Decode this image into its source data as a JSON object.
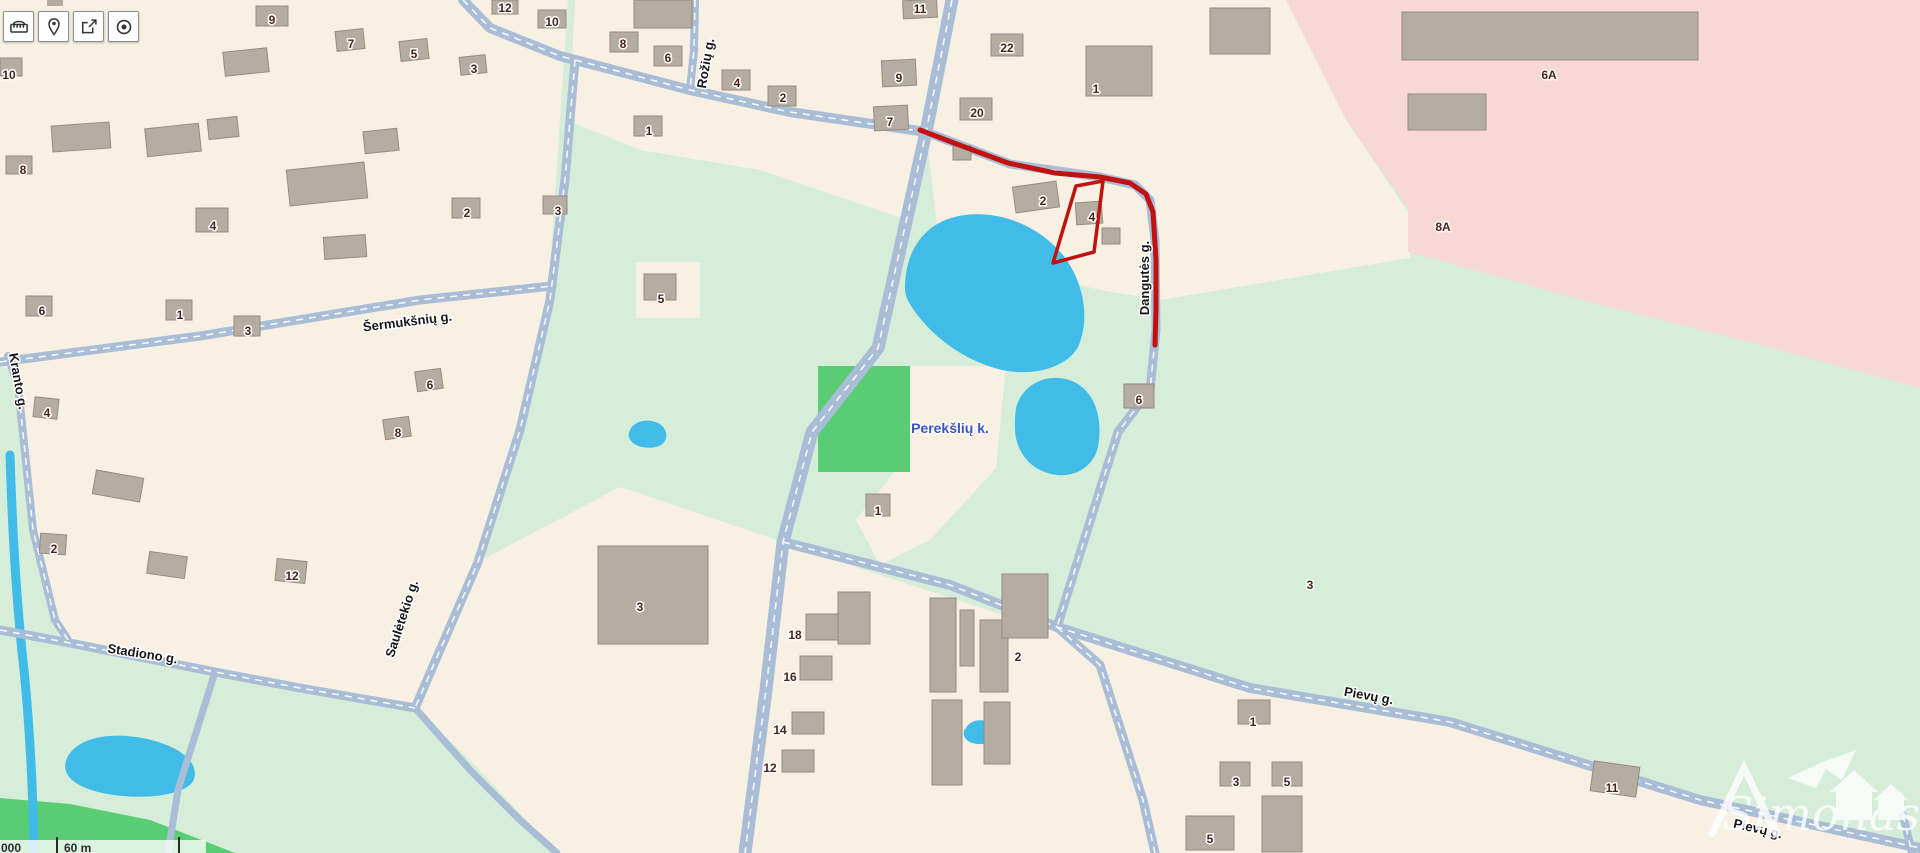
{
  "title": "Map viewer — Perekšlių k.",
  "toolbar": {
    "buttons": [
      {
        "name": "measure",
        "icon": "ruler-icon"
      },
      {
        "name": "location-pin",
        "icon": "pin-icon"
      },
      {
        "name": "share",
        "icon": "share-icon"
      },
      {
        "name": "locate",
        "icon": "target-icon"
      }
    ]
  },
  "scalebar": {
    "left_text": "000",
    "label": "60 m"
  },
  "watermark": {
    "text": "Simonas"
  },
  "map": {
    "colors": {
      "base": "#d6edd9",
      "cream": "#f8f0e2",
      "pink": "#f8d8d4",
      "green": "#58cd74",
      "water": "#41bce8",
      "road": "#a9bdd6",
      "building": "#b5ada1",
      "building_edge": "#948c7f",
      "red": "#c11212",
      "number_text": "#4a241c",
      "street_text": "#161616",
      "place_text": "#3a53c4"
    },
    "areas": [
      {
        "name": "left-residential-block",
        "color": "cream",
        "pts": "0,0 568,0 560,120 548,300 520,430 478,562 415,708 215,672 70,643 0,628"
      },
      {
        "name": "top-middle-block",
        "color": "cream",
        "pts": "575,0 952,0 926,132 908,220 760,170 640,150 566,120 572,60"
      },
      {
        "name": "kranto-wedge-meadow",
        "color": "base",
        "pts": "0,366 12,370 26,460 40,560 62,628 72,646 0,636"
      },
      {
        "name": "patch-house5",
        "color": "cream",
        "pts": "636,262 700,262 700,318 636,318"
      },
      {
        "name": "northeast-block",
        "color": "cream",
        "pts": "926,0 1286,0 1346,120 1410,215 1410,258 1160,300 1100,290 1040,275 980,280 940,250 926,132"
      },
      {
        "name": "industrial-pink-zone",
        "color": "pink",
        "pts": "1286,0 1920,0 1920,388 1760,345 1600,305 1408,252 1408,208 1346,120"
      },
      {
        "name": "perekslu-farm-column",
        "color": "cream",
        "pts": "908,366 1006,366 996,468 930,540 880,565 856,520 896,470 905,420"
      },
      {
        "name": "playground-green",
        "color": "green",
        "pts": "818,366 910,366 910,472 818,472"
      },
      {
        "name": "southwest-center-block",
        "color": "cream",
        "pts": "478,562 620,487 783,542 766,690 748,853 557,853 470,760 415,708"
      },
      {
        "name": "industrial-south-block",
        "color": "cream",
        "pts": "788,545 1055,632 1100,668 1143,800 1153,853 750,853 770,690"
      },
      {
        "name": "southeast-block",
        "color": "cream",
        "pts": "1055,632 1250,690 1450,724 1700,802 1920,850 1920,853 1155,853 1143,800 1100,668"
      },
      {
        "name": "corner-green-strip",
        "color": "green",
        "pts": "0,798 70,804 150,820 235,853 0,853"
      }
    ],
    "lakes": [
      {
        "name": "big-pond",
        "d": "M905,288C905,250 925,220 965,215C1008,210 1048,232 1068,262C1084,287 1090,320 1078,347C1065,370 1028,377 998,369C962,359 936,338 919,317C908,303 905,296 905,288Z"
      },
      {
        "name": "small-pond-east",
        "d": "M1019,400C1029,379 1056,372 1076,383C1096,394 1103,420 1098,447C1093,468 1073,479 1051,474C1029,469 1015,450 1015,428C1015,416 1015,407 1019,400Z"
      },
      {
        "name": "tiny-pond-center",
        "d": "M630,430C634,421 648,418 658,423C668,428 669,440 661,445C652,450 637,448 631,441C628,437 628,434 630,430Z"
      },
      {
        "name": "southwest-pond",
        "d": "M67,758C77,737 112,731 147,739C182,747 199,763 194,779C189,794 150,800 114,795C84,791 58,779 67,758Z"
      },
      {
        "name": "tiny-pond-south",
        "d": "M966,728C970,720 982,718 989,723C996,728 996,738 989,742C981,746 969,744 965,738C963,734 963,731 966,728Z"
      }
    ],
    "stream": {
      "name": "west-stream",
      "d": "M10,455C12,520 16,600 24,670C30,730 33,790 34,853",
      "w": 9
    },
    "roads": [
      {
        "name": "main-road-north-south",
        "w": 13,
        "pts": [
          [
            952,
            0
          ],
          [
            926,
            132
          ],
          [
            878,
            348
          ],
          [
            812,
            432
          ],
          [
            783,
            542
          ],
          [
            766,
            690
          ],
          [
            745,
            853
          ]
        ]
      },
      {
        "name": "upper-east-west-road",
        "w": 10,
        "pts": [
          [
            463,
            0
          ],
          [
            490,
            28
          ],
          [
            560,
            56
          ],
          [
            690,
            90
          ],
          [
            790,
            112
          ],
          [
            926,
            132
          ]
        ]
      },
      {
        "name": "dangutes-road",
        "w": 9,
        "pts": [
          [
            926,
            132
          ],
          [
            1010,
            164
          ],
          [
            1100,
            177
          ],
          [
            1135,
            185
          ],
          [
            1150,
            200
          ],
          [
            1155,
            240
          ],
          [
            1156,
            330
          ],
          [
            1150,
            390
          ],
          [
            1118,
            432
          ],
          [
            1057,
            627
          ]
        ]
      },
      {
        "name": "sauletekio-road",
        "w": 9,
        "pts": [
          [
            575,
            60
          ],
          [
            565,
            180
          ],
          [
            550,
            300
          ],
          [
            520,
            430
          ],
          [
            478,
            562
          ],
          [
            415,
            708
          ]
        ]
      },
      {
        "name": "sermuksnu-road",
        "w": 9,
        "pts": [
          [
            0,
            362
          ],
          [
            200,
            336
          ],
          [
            420,
            300
          ],
          [
            552,
            286
          ]
        ]
      },
      {
        "name": "stadiono-road",
        "w": 9,
        "pts": [
          [
            0,
            630
          ],
          [
            70,
            643
          ],
          [
            215,
            672
          ],
          [
            300,
            688
          ],
          [
            415,
            708
          ]
        ]
      },
      {
        "name": "stadiono-south-branch",
        "w": 7,
        "pts": [
          [
            215,
            672
          ],
          [
            200,
            720
          ],
          [
            178,
            790
          ],
          [
            168,
            853
          ]
        ]
      },
      {
        "name": "sauletekio-south-branch",
        "w": 7,
        "pts": [
          [
            415,
            708
          ],
          [
            470,
            770
          ],
          [
            520,
            820
          ],
          [
            557,
            853
          ]
        ]
      },
      {
        "name": "pievu-road",
        "w": 10,
        "pts": [
          [
            783,
            542
          ],
          [
            950,
            585
          ],
          [
            1057,
            627
          ],
          [
            1250,
            688
          ],
          [
            1450,
            722
          ],
          [
            1700,
            800
          ],
          [
            1920,
            848
          ]
        ]
      },
      {
        "name": "industrial-east-road",
        "w": 9,
        "pts": [
          [
            1057,
            627
          ],
          [
            1100,
            665
          ],
          [
            1143,
            800
          ],
          [
            1155,
            853
          ]
        ]
      },
      {
        "name": "roziu-road",
        "w": 8,
        "pts": [
          [
            695,
            0
          ],
          [
            694,
            50
          ],
          [
            690,
            90
          ]
        ]
      },
      {
        "name": "kranto-road",
        "w": 8,
        "pts": [
          [
            8,
            356
          ],
          [
            18,
            385
          ],
          [
            33,
            530
          ],
          [
            55,
            620
          ],
          [
            70,
            643
          ]
        ]
      },
      {
        "name": "corner-road",
        "w": 8,
        "pts": [
          [
            1903,
            815
          ],
          [
            1912,
            853
          ]
        ]
      }
    ],
    "buildings": [
      [
        256,
        6,
        32,
        20,
        0
      ],
      [
        336,
        30,
        28,
        20,
        -6
      ],
      [
        400,
        40,
        28,
        20,
        -6
      ],
      [
        460,
        56,
        26,
        18,
        -6
      ],
      [
        0,
        58,
        22,
        18,
        0
      ],
      [
        6,
        156,
        26,
        18,
        0
      ],
      [
        196,
        208,
        32,
        24,
        0
      ],
      [
        452,
        198,
        28,
        20,
        0
      ],
      [
        543,
        196,
        24,
        18,
        0
      ],
      [
        26,
        296,
        26,
        20,
        0
      ],
      [
        166,
        300,
        26,
        20,
        0
      ],
      [
        234,
        316,
        26,
        20,
        0
      ],
      [
        416,
        370,
        26,
        20,
        -8
      ],
      [
        384,
        418,
        26,
        20,
        -8
      ],
      [
        34,
        398,
        24,
        20,
        6
      ],
      [
        40,
        534,
        26,
        20,
        4
      ],
      [
        276,
        560,
        30,
        22,
        6
      ],
      [
        288,
        166,
        78,
        36,
        -6
      ],
      [
        146,
        126,
        54,
        28,
        -6
      ],
      [
        52,
        124,
        58,
        26,
        -4
      ],
      [
        224,
        50,
        44,
        24,
        -6
      ],
      [
        324,
        236,
        42,
        22,
        -4
      ],
      [
        94,
        474,
        48,
        24,
        10
      ],
      [
        148,
        554,
        38,
        22,
        8
      ],
      [
        208,
        118,
        30,
        20,
        -6
      ],
      [
        364,
        130,
        34,
        22,
        -6
      ],
      [
        492,
        0,
        26,
        14,
        0
      ],
      [
        538,
        10,
        28,
        18,
        0
      ],
      [
        610,
        32,
        28,
        20,
        0
      ],
      [
        654,
        46,
        28,
        20,
        0
      ],
      [
        634,
        0,
        58,
        28,
        0
      ],
      [
        722,
        70,
        28,
        20,
        0
      ],
      [
        768,
        86,
        28,
        20,
        0
      ],
      [
        634,
        116,
        28,
        20,
        0
      ],
      [
        644,
        274,
        32,
        26,
        0
      ],
      [
        903,
        0,
        34,
        18,
        -3
      ],
      [
        882,
        60,
        34,
        26,
        -3
      ],
      [
        874,
        106,
        34,
        24,
        -3
      ],
      [
        991,
        34,
        32,
        22,
        0
      ],
      [
        960,
        98,
        32,
        22,
        0
      ],
      [
        1086,
        46,
        66,
        50,
        0
      ],
      [
        1014,
        184,
        44,
        26,
        -8
      ],
      [
        1076,
        202,
        26,
        22,
        -4
      ],
      [
        1102,
        228,
        18,
        16,
        0
      ],
      [
        953,
        146,
        18,
        14,
        0
      ],
      [
        1124,
        384,
        30,
        24,
        0
      ],
      [
        1402,
        12,
        296,
        48,
        0
      ],
      [
        1408,
        94,
        78,
        36,
        0
      ],
      [
        1210,
        8,
        60,
        46,
        0
      ],
      [
        598,
        546,
        110,
        98,
        0
      ],
      [
        806,
        614,
        38,
        26,
        0
      ],
      [
        800,
        656,
        32,
        24,
        0
      ],
      [
        792,
        712,
        32,
        22,
        0
      ],
      [
        782,
        750,
        32,
        22,
        0
      ],
      [
        838,
        592,
        32,
        52,
        0
      ],
      [
        930,
        598,
        26,
        94,
        0
      ],
      [
        960,
        610,
        14,
        56,
        0
      ],
      [
        980,
        620,
        28,
        72,
        0
      ],
      [
        1002,
        574,
        46,
        64,
        0
      ],
      [
        932,
        700,
        30,
        85,
        0
      ],
      [
        984,
        702,
        26,
        62,
        0
      ],
      [
        866,
        494,
        24,
        22,
        0
      ],
      [
        1238,
        700,
        32,
        24,
        0
      ],
      [
        1220,
        762,
        30,
        24,
        0
      ],
      [
        1272,
        762,
        30,
        24,
        0
      ],
      [
        1592,
        764,
        46,
        30,
        8
      ],
      [
        1186,
        816,
        48,
        34,
        0
      ],
      [
        1262,
        796,
        40,
        56,
        0
      ]
    ],
    "house_numbers": [
      [
        "9",
        272,
        20
      ],
      [
        "7",
        351,
        44
      ],
      [
        "5",
        414,
        54
      ],
      [
        "3",
        474,
        69
      ],
      [
        "10",
        9,
        75
      ],
      [
        "8",
        23,
        170
      ],
      [
        "4",
        213,
        226
      ],
      [
        "2",
        467,
        213
      ],
      [
        "3",
        558,
        211
      ],
      [
        "6",
        42,
        311
      ],
      [
        "1",
        180,
        315
      ],
      [
        "3",
        248,
        331
      ],
      [
        "6",
        430,
        385
      ],
      [
        "8",
        398,
        433
      ],
      [
        "4",
        47,
        413
      ],
      [
        "2",
        54,
        549
      ],
      [
        "12",
        292,
        576
      ],
      [
        "12",
        505,
        8
      ],
      [
        "10",
        552,
        22
      ],
      [
        "8",
        623,
        44
      ],
      [
        "6",
        668,
        58
      ],
      [
        "4",
        737,
        83
      ],
      [
        "2",
        783,
        98
      ],
      [
        "1",
        649,
        131
      ],
      [
        "5",
        661,
        299
      ],
      [
        "11",
        920,
        9
      ],
      [
        "9",
        899,
        78
      ],
      [
        "7",
        890,
        122
      ],
      [
        "22",
        1007,
        48
      ],
      [
        "20",
        977,
        113
      ],
      [
        "1",
        1096,
        89
      ],
      [
        "2",
        1043,
        201
      ],
      [
        "4",
        1092,
        217
      ],
      [
        "6",
        1139,
        400
      ],
      [
        "6A",
        1549,
        75
      ],
      [
        "8A",
        1443,
        227
      ],
      [
        "3",
        640,
        607
      ],
      [
        "18",
        795,
        635
      ],
      [
        "16",
        790,
        677
      ],
      [
        "14",
        780,
        730
      ],
      [
        "12",
        770,
        768
      ],
      [
        "2",
        1018,
        657
      ],
      [
        "1",
        878,
        511
      ],
      [
        "3",
        1310,
        585
      ],
      [
        "1",
        1253,
        722
      ],
      [
        "3",
        1236,
        782
      ],
      [
        "5",
        1287,
        782
      ],
      [
        "11",
        1612,
        788
      ],
      [
        "5",
        1210,
        839
      ]
    ],
    "street_labels": [
      {
        "text": "Šermukšnių g.",
        "x": 408,
        "y": 326,
        "rot": -7
      },
      {
        "text": "Kranto g.",
        "x": 14,
        "y": 382,
        "rot": 80
      },
      {
        "text": "Saulėtekio g.",
        "x": 406,
        "y": 620,
        "rot": -72
      },
      {
        "text": "Stadiono g.",
        "x": 142,
        "y": 658,
        "rot": 9
      },
      {
        "text": "Rožių g.",
        "x": 710,
        "y": 64,
        "rot": -80
      },
      {
        "text": "Dangutės g.",
        "x": 1149,
        "y": 278,
        "rot": -90
      },
      {
        "text": "Pievų g.",
        "x": 1368,
        "y": 700,
        "rot": 10
      },
      {
        "text": "Pievų g.",
        "x": 1757,
        "y": 833,
        "rot": 13
      }
    ],
    "place_labels": [
      {
        "text": "Perekšlių k.",
        "x": 950,
        "y": 433
      }
    ],
    "annotations": {
      "route": {
        "name": "drawn-route",
        "pts": [
          [
            920,
            130
          ],
          [
            962,
            146
          ],
          [
            1008,
            163
          ],
          [
            1055,
            173
          ],
          [
            1100,
            177
          ],
          [
            1130,
            183
          ],
          [
            1146,
            194
          ],
          [
            1153,
            212
          ],
          [
            1156,
            260
          ],
          [
            1156,
            310
          ],
          [
            1155,
            345
          ]
        ],
        "w": 5
      },
      "parcel": {
        "name": "drawn-parcel-outline",
        "pts": "1076,186 1103,181 1094,252 1053,263",
        "w": 3.5
      }
    }
  }
}
